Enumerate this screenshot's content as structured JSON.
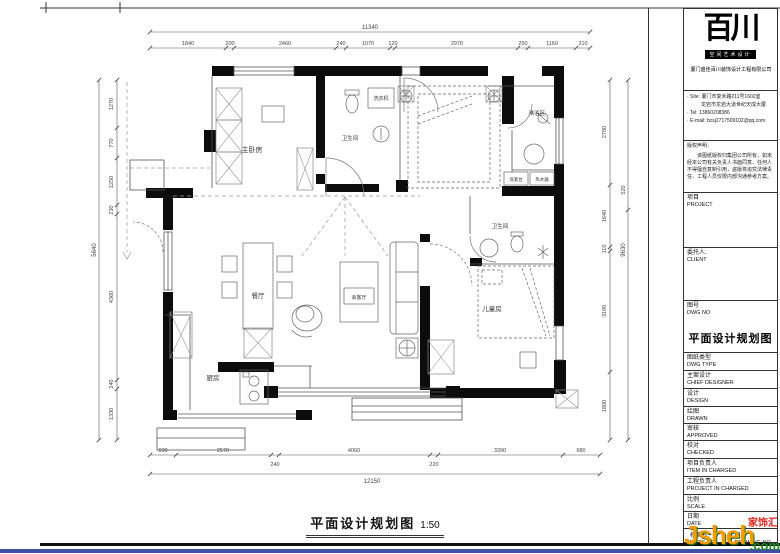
{
  "sheet": {
    "caption": "平面设计规划图",
    "caption_scale": "1:50"
  },
  "plan": {
    "rooms": {
      "master_bedroom": "主卧房",
      "bath1": "卫生间",
      "washer": "洗衣机",
      "shower": "淋浴区",
      "cabinet1": "洗漱台",
      "cabinet2": "热水器",
      "bath2": "卫生间",
      "kids_room": "儿童房",
      "living": "会客厅",
      "dining": "餐厅",
      "kitchen": "厨房"
    },
    "dims": {
      "top": {
        "total": "11340",
        "segments": [
          "1840",
          "200",
          "2460",
          "240",
          "1070",
          "120",
          "2970",
          "250",
          "1160",
          "310"
        ]
      },
      "bottom": {
        "row1": [
          "690",
          "2570",
          "4060",
          "3390",
          "980"
        ],
        "row2": [
          "240",
          "220"
        ],
        "total": "12150"
      },
      "left": {
        "outer": "5640",
        "segments": [
          "1270",
          "770",
          "1250",
          "230",
          "4360",
          "240",
          "1330"
        ]
      },
      "right": {
        "outer_a": "520",
        "outer_b": "9630",
        "segments": [
          "2780",
          "1640",
          "110",
          "3190",
          "1800"
        ]
      }
    }
  },
  "titleblock": {
    "logo": {
      "name": "百川",
      "tagline": "空间艺术设计",
      "company": "厦门盛佳百川装饰设计工程有限公司"
    },
    "contact": {
      "site1": "· Site: 厦门市复禾路211号1602室",
      "site2": "龙岩市龙岩大道世纪天成大厦",
      "tel": "· Tel: 13860208386",
      "email": "· E-mail: bcsj2717509102@qq.com"
    },
    "notice_title": "版权声明：",
    "notice_body": "该图纸版权归集团公司所有，如未经本公司有关负责人书面同意，任何人不得擅自复制引用，盗版将追究法律责任，工程人员仅限内部沟通参考方案。",
    "fields": {
      "project": {
        "zh": "项目",
        "en": "PROJECT"
      },
      "client": {
        "zh": "委托人:",
        "en": "CLIENT"
      },
      "dwg_no": {
        "zh": "图号",
        "en": "DWG  NO"
      },
      "dwg_title": "平面设计规划图",
      "dwg_type": {
        "zh": "图纸类型",
        "en": "DWG TYPE"
      },
      "chief": {
        "zh": "主案设计",
        "en": "CHIEF  DESIGNER"
      },
      "design": {
        "zh": "设计",
        "en": "DESIGN"
      },
      "drawn": {
        "zh": "绘图",
        "en": "DRAWN"
      },
      "approved": {
        "zh": "审核",
        "en": "APPROVED"
      },
      "checked": {
        "zh": "校对",
        "en": "CHECKED"
      },
      "item_in_charge": {
        "zh": "项目负责人",
        "en": "ITEM  IN  CHARGED"
      },
      "project_in_charge": {
        "zh": "工程负责人",
        "en": "PROJECT IN CHARGED"
      },
      "scale": {
        "zh": "比例",
        "en": "SCALE"
      },
      "date": {
        "zh": "日期",
        "en": "DATE"
      },
      "files_no": {
        "zh": "档案号:",
        "en": "FILES  NO"
      },
      "drawing_no": {
        "zh": "图号",
        "en": "DRAWING  NO"
      }
    }
  },
  "watermark": {
    "tag": "家饰汇",
    "site_main": "Jsheh",
    "site_suffix": ".com",
    "color_orange": "#f59b00",
    "color_green": "#1e8c1e",
    "color_red": "#e2231a",
    "color_blue": "#3f51a5"
  }
}
